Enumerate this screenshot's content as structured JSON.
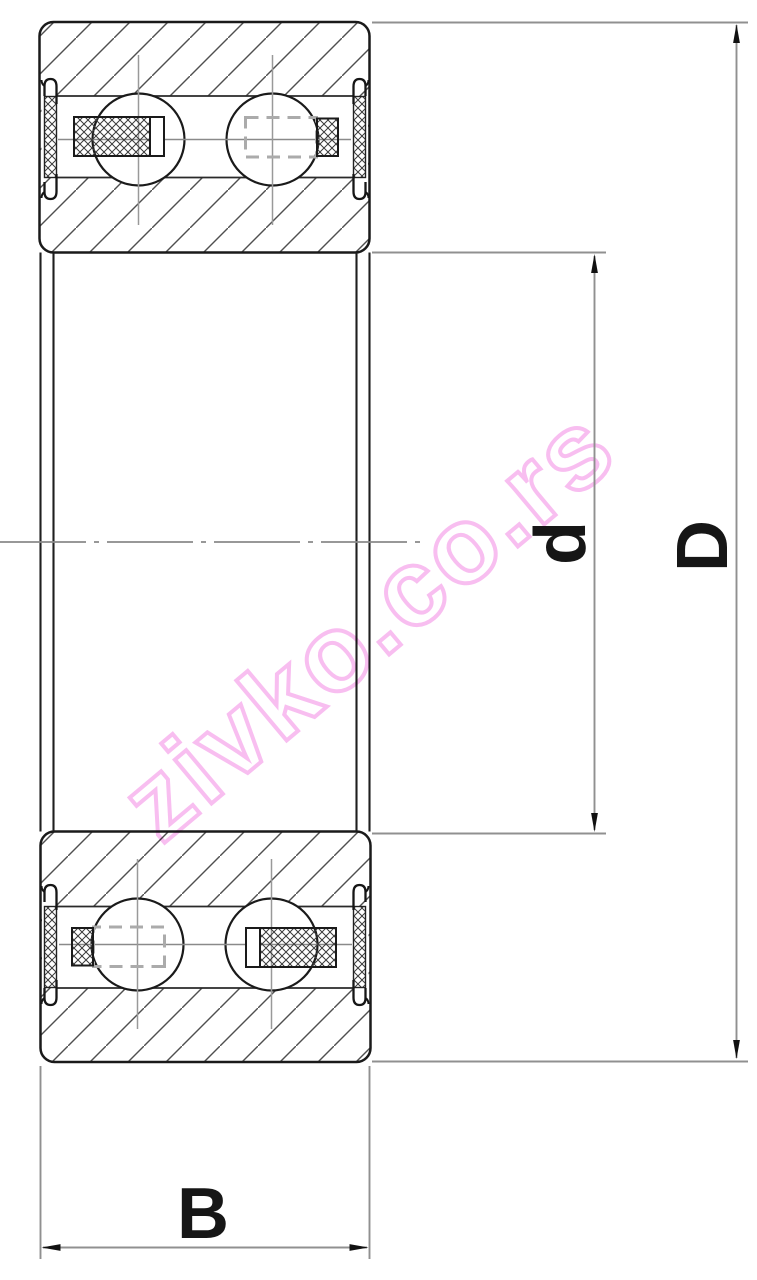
{
  "drawing": {
    "dimension_labels": {
      "bore_diameter": "d",
      "outer_diameter": "D",
      "width": "B"
    },
    "watermark_text": "zivko.co.rs",
    "colors": {
      "background": "#ffffff",
      "outline": "#1a1a1a",
      "hatch_line": "#4f4f4f",
      "crosshatch_line": "#3a3a3a",
      "centerline": "#8a8a8a",
      "dimension_line": "#909090",
      "arrowhead": "#111111",
      "dashed_cage": "#ababab",
      "watermark_pink": "#f7b3ee"
    }
  }
}
